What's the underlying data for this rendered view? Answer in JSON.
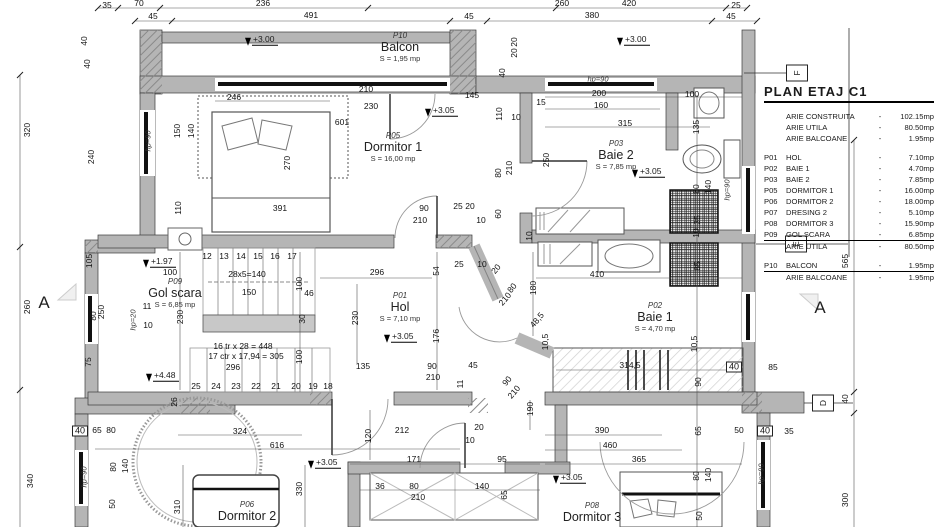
{
  "legend": {
    "title": "PLAN ETAJ C1",
    "rows": [
      {
        "c": "",
        "l": "ARIE CONSTRUITA",
        "v": "102.15mp",
        "cls": ""
      },
      {
        "c": "",
        "l": "ARIE UTILA",
        "v": "80.50mp",
        "cls": ""
      },
      {
        "c": "",
        "l": "ARIE BALCOANE",
        "v": "1.95mp",
        "cls": "gap-after"
      },
      {
        "c": "P01",
        "l": "HOL",
        "v": "7.10mp",
        "cls": ""
      },
      {
        "c": "P02",
        "l": "BAIE 1",
        "v": "4.70mp",
        "cls": ""
      },
      {
        "c": "P03",
        "l": "BAIE 2",
        "v": "7.85mp",
        "cls": ""
      },
      {
        "c": "P05",
        "l": "DORMITOR 1",
        "v": "16.00mp",
        "cls": ""
      },
      {
        "c": "P06",
        "l": "DORMITOR 2",
        "v": "18.00mp",
        "cls": ""
      },
      {
        "c": "P07",
        "l": "DRESING 2",
        "v": "5.10mp",
        "cls": ""
      },
      {
        "c": "P08",
        "l": "DORMITOR 3",
        "v": "15.90mp",
        "cls": ""
      },
      {
        "c": "P09",
        "l": "GOL SCARA",
        "v": "6.85mp",
        "cls": ""
      },
      {
        "c": "",
        "l": "ARIE UTILA",
        "v": "80.50mp",
        "cls": "total gap-after"
      },
      {
        "c": "P10",
        "l": "BALCON",
        "v": "1.95mp",
        "cls": ""
      },
      {
        "c": "",
        "l": "ARIE BALCOANE",
        "v": "1.95mp",
        "cls": "total"
      }
    ]
  },
  "rooms": [
    {
      "code": "P10",
      "name": "Balcon",
      "area": "S = 1,95 mp",
      "x": 400,
      "y": 47
    },
    {
      "code": "P05",
      "name": "Dormitor 1",
      "area": "S = 16,00 mp",
      "x": 393,
      "y": 147
    },
    {
      "code": "P03",
      "name": "Baie 2",
      "area": "S = 7,85 mp",
      "x": 616,
      "y": 155
    },
    {
      "code": "P09",
      "name": "Gol scara",
      "area": "S = 6,85 mp",
      "x": 175,
      "y": 293
    },
    {
      "code": "P01",
      "name": "Hol",
      "area": "S = 7,10 mp",
      "x": 400,
      "y": 307
    },
    {
      "code": "P02",
      "name": "Baie 1",
      "area": "S = 4,70 mp",
      "x": 655,
      "y": 317
    },
    {
      "code": "P06",
      "name": "Dormitor 2",
      "area": "",
      "x": 247,
      "y": 512
    },
    {
      "code": "P08",
      "name": "Dormitor 3",
      "area": "",
      "x": 592,
      "y": 513
    }
  ],
  "levels": [
    {
      "t": "+3.00",
      "x": 258,
      "y": 40
    },
    {
      "t": "+3.00",
      "x": 630,
      "y": 40
    },
    {
      "t": "+3.05",
      "x": 438,
      "y": 111
    },
    {
      "t": "+3.05",
      "x": 645,
      "y": 172
    },
    {
      "t": "+3.05",
      "x": 397,
      "y": 337
    },
    {
      "t": "+3.05",
      "x": 321,
      "y": 463
    },
    {
      "t": "+3.05",
      "x": 566,
      "y": 478
    },
    {
      "t": "+1.97",
      "x": 156,
      "y": 262
    },
    {
      "t": "+4.48",
      "x": 159,
      "y": 376
    }
  ],
  "sections": [
    {
      "letter": "A",
      "x": 44,
      "y": 303,
      "style": "big"
    },
    {
      "letter": "A",
      "x": 820,
      "y": 308,
      "style": "big"
    },
    {
      "letter": "F",
      "x": 797,
      "y": 73,
      "style": "boxed"
    },
    {
      "letter": "E",
      "x": 796,
      "y": 244,
      "style": "boxed"
    },
    {
      "letter": "D",
      "x": 823,
      "y": 403,
      "style": "boxed"
    }
  ],
  "dims": [
    [
      "35",
      107,
      5,
      ""
    ],
    [
      "70",
      139,
      3,
      ""
    ],
    [
      "236",
      263,
      3,
      ""
    ],
    [
      "260",
      562,
      3,
      ""
    ],
    [
      "420",
      629,
      3,
      ""
    ],
    [
      "25",
      736,
      5,
      ""
    ],
    [
      "45",
      153,
      16,
      ""
    ],
    [
      "491",
      311,
      15,
      ""
    ],
    [
      "45",
      469,
      16,
      ""
    ],
    [
      "380",
      592,
      15,
      ""
    ],
    [
      "45",
      731,
      16,
      ""
    ],
    [
      "320",
      27,
      130,
      "r"
    ],
    [
      "260",
      27,
      307,
      "r"
    ],
    [
      "340",
      30,
      481,
      "r"
    ],
    [
      "40",
      84,
      41,
      "r"
    ],
    [
      "40",
      87,
      64,
      "r"
    ],
    [
      "240",
      91,
      157,
      "r"
    ],
    [
      "105",
      89,
      261,
      "r"
    ],
    [
      "80",
      93,
      316,
      "r"
    ],
    [
      "250",
      101,
      312,
      "r"
    ],
    [
      "75",
      88,
      362,
      "r"
    ],
    [
      "40",
      80,
      431,
      "b"
    ],
    [
      "65",
      97,
      430,
      ""
    ],
    [
      "80",
      111,
      430,
      ""
    ],
    [
      "80",
      113,
      467,
      "r"
    ],
    [
      "140",
      125,
      466,
      "r"
    ],
    [
      "50",
      112,
      504,
      "r"
    ],
    [
      "310",
      177,
      507,
      "r"
    ],
    [
      "hp=90",
      148,
      141,
      "ri"
    ],
    [
      "hp=20",
      133,
      320,
      "ri"
    ],
    [
      "hp=90",
      84,
      477,
      "ri"
    ],
    [
      "hp=90",
      727,
      190,
      "ri"
    ],
    [
      "hp=90",
      761,
      474,
      "ri"
    ],
    [
      "hp=90",
      598,
      79,
      "i"
    ],
    [
      "246",
      234,
      97,
      ""
    ],
    [
      "150",
      177,
      131,
      "r"
    ],
    [
      "140",
      191,
      131,
      "r"
    ],
    [
      "270",
      287,
      163,
      "r"
    ],
    [
      "391",
      280,
      208,
      ""
    ],
    [
      "110",
      178,
      208,
      "r"
    ],
    [
      "601",
      342,
      122,
      ""
    ],
    [
      "210",
      366,
      89,
      ""
    ],
    [
      "230",
      371,
      106,
      ""
    ],
    [
      "90",
      424,
      208,
      ""
    ],
    [
      "210",
      420,
      220,
      ""
    ],
    [
      "145",
      472,
      95,
      ""
    ],
    [
      "15",
      541,
      102,
      ""
    ],
    [
      "200",
      599,
      93,
      ""
    ],
    [
      "160",
      601,
      105,
      ""
    ],
    [
      "100",
      692,
      94,
      ""
    ],
    [
      "110",
      499,
      114,
      "r"
    ],
    [
      "10",
      516,
      117,
      ""
    ],
    [
      "315",
      625,
      123,
      ""
    ],
    [
      "135",
      696,
      127,
      "r"
    ],
    [
      "20",
      514,
      42,
      "r"
    ],
    [
      "20",
      514,
      53,
      "r"
    ],
    [
      "40",
      502,
      73,
      "r"
    ],
    [
      "250",
      546,
      160,
      "r"
    ],
    [
      "210",
      509,
      168,
      "r"
    ],
    [
      "80",
      498,
      173,
      "r"
    ],
    [
      "60",
      498,
      214,
      "r"
    ],
    [
      "25",
      458,
      206,
      ""
    ],
    [
      "20",
      470,
      206,
      ""
    ],
    [
      "10",
      481,
      220,
      ""
    ],
    [
      "10",
      529,
      236,
      "r"
    ],
    [
      "80",
      696,
      189,
      "r"
    ],
    [
      "140",
      708,
      187,
      "r"
    ],
    [
      "35",
      697,
      220,
      "r"
    ],
    [
      "10",
      696,
      233,
      "r"
    ],
    [
      "85",
      697,
      266,
      "r"
    ],
    [
      "100",
      170,
      272,
      ""
    ],
    [
      "28x5=140",
      247,
      274,
      ""
    ],
    [
      "150",
      249,
      292,
      ""
    ],
    [
      "46",
      309,
      293,
      ""
    ],
    [
      "100",
      299,
      284,
      "r"
    ],
    [
      "30",
      302,
      319,
      "r"
    ],
    [
      "230",
      180,
      317,
      "r"
    ],
    [
      "10",
      148,
      325,
      ""
    ],
    [
      "11",
      147,
      306,
      ""
    ],
    [
      "16 tr x 28 = 448",
      243,
      346,
      ""
    ],
    [
      "17 ctr x 17,94 = 305",
      246,
      356,
      ""
    ],
    [
      "296",
      233,
      367,
      ""
    ],
    [
      "100",
      299,
      357,
      "r"
    ],
    [
      "12",
      207,
      256,
      ""
    ],
    [
      "13",
      224,
      256,
      ""
    ],
    [
      "14",
      241,
      256,
      ""
    ],
    [
      "15",
      258,
      256,
      ""
    ],
    [
      "16",
      275,
      256,
      ""
    ],
    [
      "17",
      292,
      256,
      ""
    ],
    [
      "25",
      196,
      386,
      ""
    ],
    [
      "24",
      216,
      386,
      ""
    ],
    [
      "23",
      236,
      386,
      ""
    ],
    [
      "22",
      256,
      386,
      ""
    ],
    [
      "21",
      276,
      386,
      ""
    ],
    [
      "20",
      296,
      386,
      ""
    ],
    [
      "19",
      313,
      386,
      ""
    ],
    [
      "18",
      328,
      386,
      ""
    ],
    [
      "296",
      377,
      272,
      ""
    ],
    [
      "230",
      355,
      318,
      "r"
    ],
    [
      "135",
      363,
      366,
      ""
    ],
    [
      "54",
      436,
      271,
      "r"
    ],
    [
      "25",
      459,
      264,
      ""
    ],
    [
      "10",
      482,
      264,
      ""
    ],
    [
      "20",
      496,
      269,
      "d"
    ],
    [
      "80",
      512,
      288,
      "d"
    ],
    [
      "210",
      505,
      299,
      "d"
    ],
    [
      "180",
      533,
      288,
      "r"
    ],
    [
      "48,5",
      537,
      320,
      "d"
    ],
    [
      "10,5",
      545,
      342,
      "r"
    ],
    [
      "176",
      436,
      336,
      "r"
    ],
    [
      "90",
      432,
      366,
      ""
    ],
    [
      "210",
      433,
      377,
      ""
    ],
    [
      "11",
      460,
      384,
      "r"
    ],
    [
      "45",
      473,
      365,
      ""
    ],
    [
      "90",
      507,
      381,
      "d"
    ],
    [
      "210",
      514,
      392,
      "d"
    ],
    [
      "410",
      597,
      274,
      ""
    ],
    [
      "314,5",
      630,
      365,
      ""
    ],
    [
      "10,5",
      694,
      344,
      "r"
    ],
    [
      "90",
      698,
      382,
      "r"
    ],
    [
      "65",
      698,
      431,
      "r"
    ],
    [
      "85",
      773,
      367,
      ""
    ],
    [
      "40",
      734,
      367,
      "b"
    ],
    [
      "50",
      739,
      430,
      ""
    ],
    [
      "40",
      765,
      431,
      "b"
    ],
    [
      "35",
      789,
      431,
      ""
    ],
    [
      "565",
      845,
      261,
      "r"
    ],
    [
      "40",
      845,
      399,
      "r"
    ],
    [
      "300",
      845,
      500,
      "r"
    ],
    [
      "120",
      368,
      436,
      "r"
    ],
    [
      "212",
      402,
      430,
      ""
    ],
    [
      "20",
      479,
      427,
      ""
    ],
    [
      "10",
      470,
      440,
      ""
    ],
    [
      "190",
      530,
      409,
      "r"
    ],
    [
      "171",
      414,
      459,
      ""
    ],
    [
      "95",
      502,
      459,
      ""
    ],
    [
      "390",
      602,
      430,
      ""
    ],
    [
      "460",
      610,
      445,
      ""
    ],
    [
      "365",
      639,
      459,
      ""
    ],
    [
      "36",
      380,
      486,
      ""
    ],
    [
      "80",
      414,
      486,
      ""
    ],
    [
      "210",
      418,
      497,
      ""
    ],
    [
      "140",
      482,
      486,
      ""
    ],
    [
      "65",
      504,
      495,
      "r"
    ],
    [
      "324",
      240,
      431,
      ""
    ],
    [
      "616",
      277,
      445,
      ""
    ],
    [
      "26",
      174,
      402,
      "r"
    ],
    [
      "330",
      299,
      489,
      "r"
    ],
    [
      "80",
      696,
      476,
      "r"
    ],
    [
      "140",
      708,
      475,
      "r"
    ],
    [
      "50",
      699,
      516,
      "r"
    ]
  ],
  "colors": {
    "wall": "#b5b5b5",
    "line": "#222222",
    "dim_line": "#555555",
    "background": "#ffffff"
  }
}
